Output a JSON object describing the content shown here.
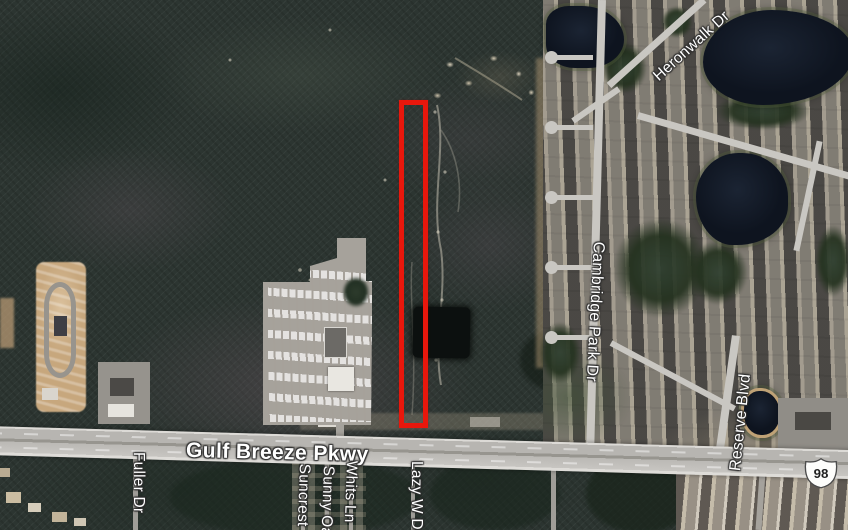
{
  "map": {
    "view": "satellite",
    "road_labels": [
      {
        "id": "gulf-breeze-pkwy",
        "label": "Gulf Breeze Pkwy"
      },
      {
        "id": "fuller-dr",
        "label": "Fuller Dr"
      },
      {
        "id": "suncrest",
        "label": "Suncrest"
      },
      {
        "id": "sunny-oak",
        "label": "Sunny Oak"
      },
      {
        "id": "whits-ln",
        "label": "Whits Ln"
      },
      {
        "id": "lazy-w-dr",
        "label": "Lazy W Dr"
      },
      {
        "id": "cambridge-park-dr",
        "label": "Cambridge Park Dr"
      },
      {
        "id": "reserve-blvd",
        "label": "Reserve Blvd"
      },
      {
        "id": "heronwalk-dr",
        "label": "Heronwalk Dr"
      }
    ],
    "route_shield": {
      "type": "us-route",
      "number": "98"
    },
    "annotation": {
      "shape": "rectangle",
      "meaning": "highlighted-parcel",
      "color": "#e8170c"
    },
    "colors": {
      "parcel_outline": "#e8170c",
      "label_text": "#ffffff",
      "label_outline": "#2d2d2d",
      "highway_fill": "#b7b5b1",
      "street_fill": "#c9c7c2",
      "water": "#10161f",
      "forest": "#2c3531",
      "cleared_dirt": "#c7a77d"
    }
  }
}
